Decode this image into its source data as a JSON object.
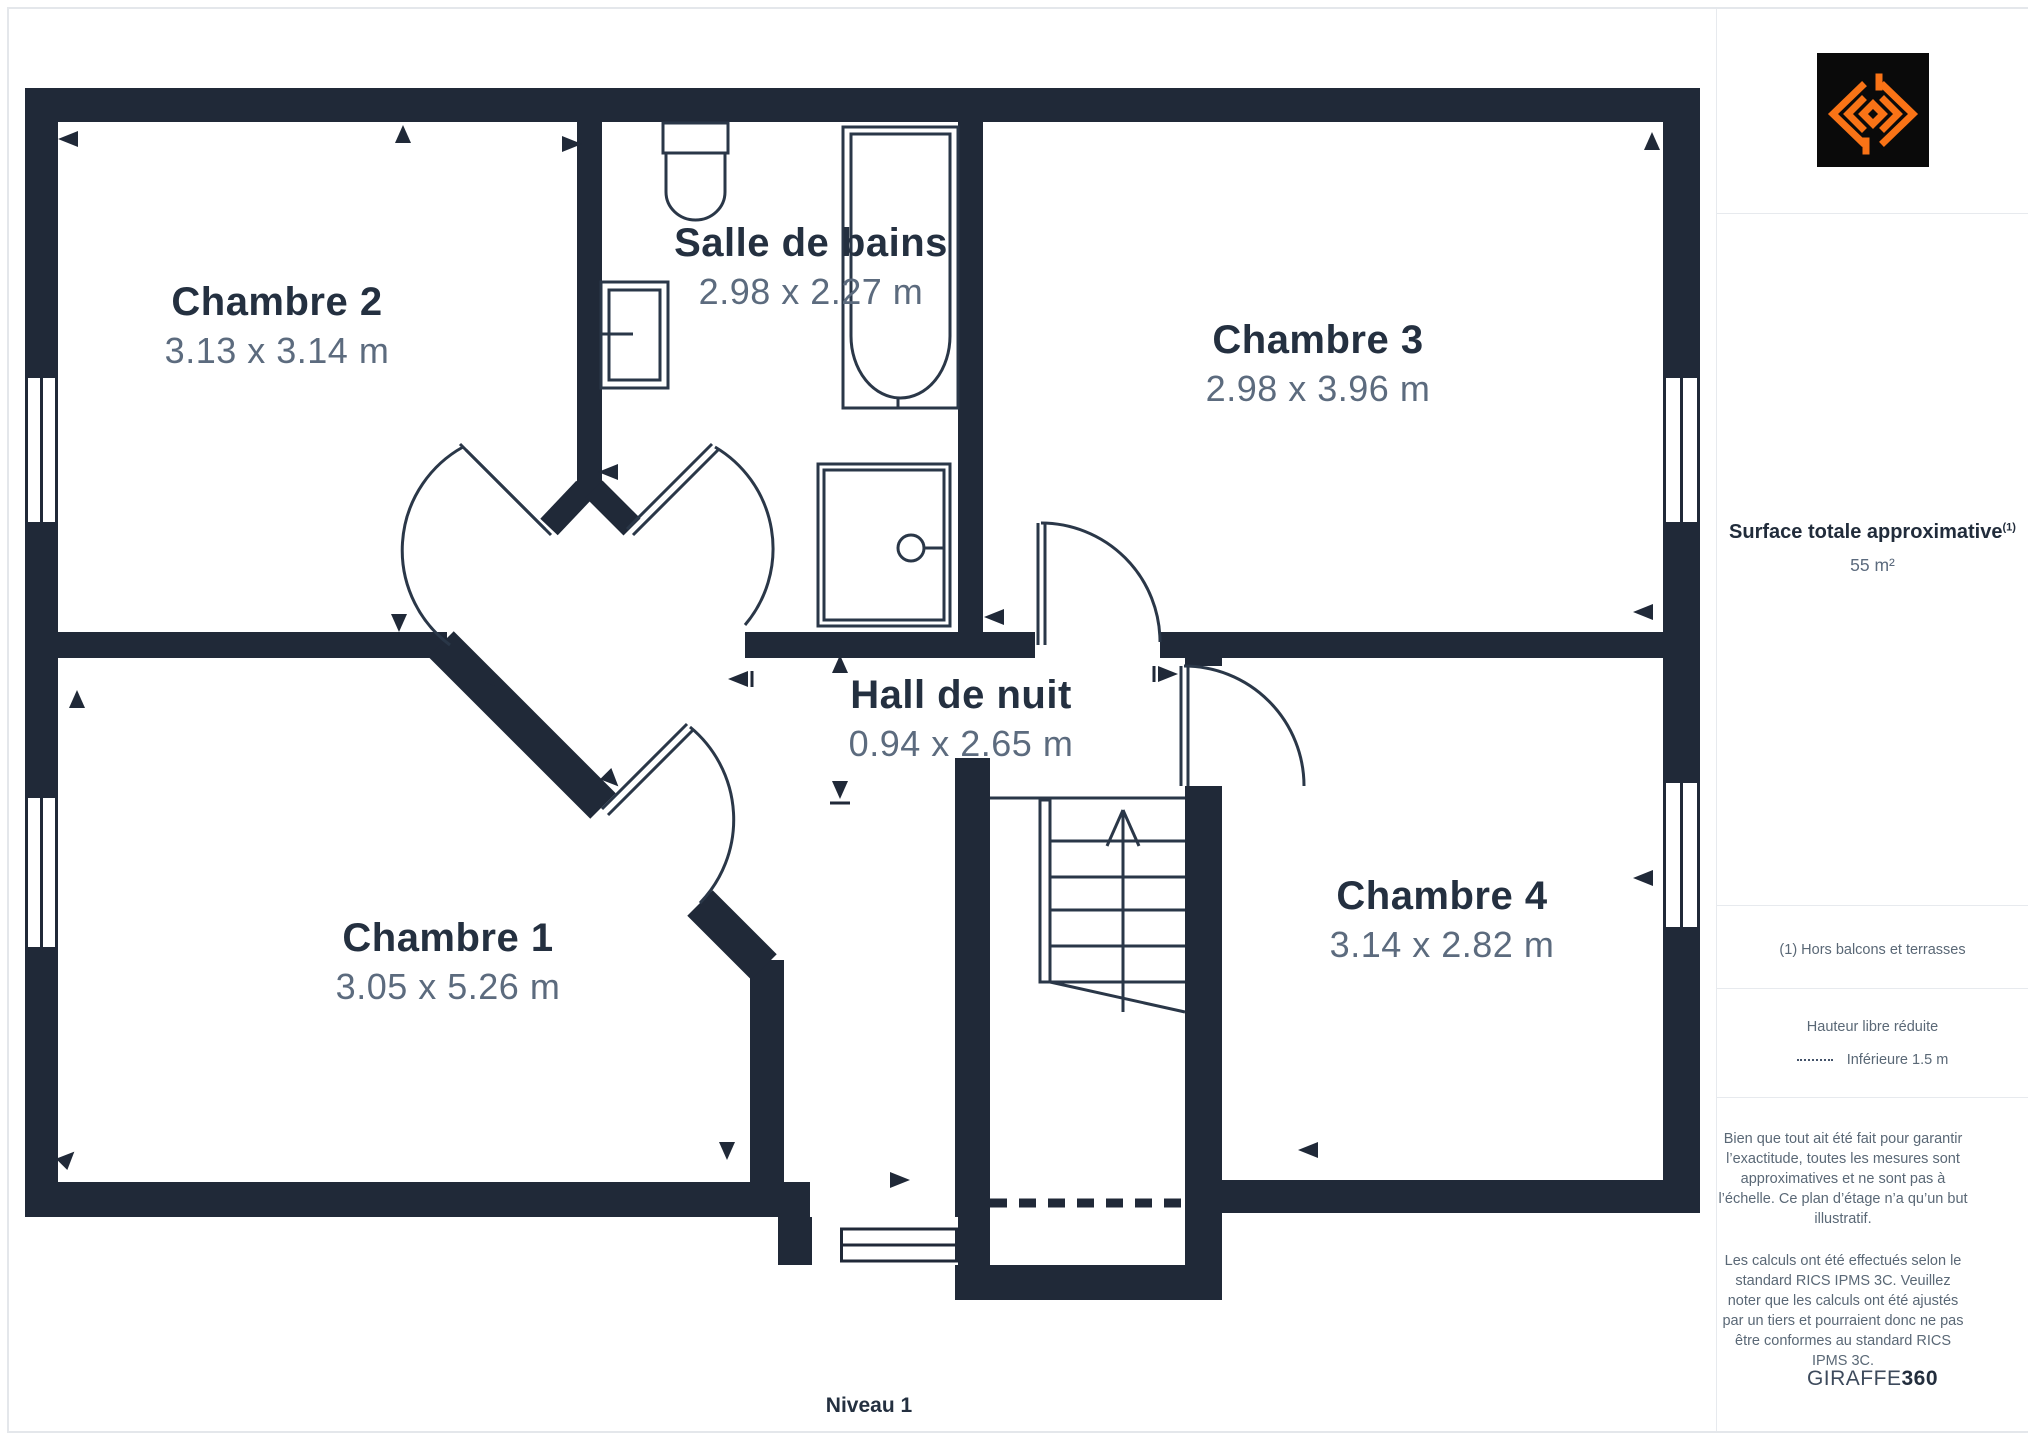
{
  "page": {
    "level_label": "Niveau 1"
  },
  "colors": {
    "wall": "#202938",
    "room_name_text": "#243040",
    "dimension_text": "#5c6b7e",
    "muted_text": "#5a6876",
    "accent_orange": "#f97316",
    "logo_background": "#0a0a0a",
    "divider": "#e7eaee"
  },
  "floorplan": {
    "rooms": [
      {
        "name": "Chambre 2",
        "dims": "3.13 x 3.14 m"
      },
      {
        "name": "Salle de bains",
        "dims": "2.98 x 2.27 m"
      },
      {
        "name": "Chambre 3",
        "dims": "2.98 x 3.96 m"
      },
      {
        "name": "Hall de nuit",
        "dims": "0.94 x 2.65 m"
      },
      {
        "name": "Chambre 1",
        "dims": "3.05 x 5.26 m"
      },
      {
        "name": "Chambre 4",
        "dims": "3.14 x 2.82 m"
      }
    ]
  },
  "sidebar": {
    "surface_title": "Surface totale approximative",
    "surface_sup": "(1)",
    "surface_value": "55 m²",
    "footnote": "(1) Hors balcons et terrasses",
    "legend_title": "Hauteur libre réduite",
    "legend_item": "Inférieure 1.5 m",
    "disclaimer_1": "Bien que tout ait été fait pour garantir l’exactitude, toutes les mesures sont approximatives et ne sont pas à l’échelle. Ce plan d’étage n’a qu’un but illustratif.",
    "disclaimer_2": "Les calculs ont été effectués selon le standard RICS IPMS 3C. Veuillez noter que les calculs ont été ajustés par un tiers et pourraient donc ne pas être conformes au standard RICS IPMS 3C.",
    "brand_regular": "GIRAFFE",
    "brand_bold": "360"
  }
}
